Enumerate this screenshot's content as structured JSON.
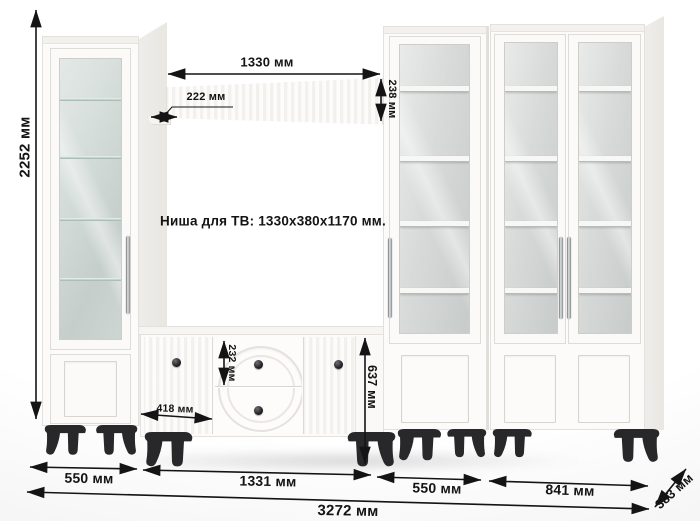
{
  "note": {
    "tv_niche": "Ниша для ТВ: 1330x380x1170 мм."
  },
  "dimensions": {
    "total_height": "2252 мм",
    "shelf_length": "1330 мм",
    "shelf_depth": "222 мм",
    "shelf_height": "238 мм",
    "drawer_height": "232 мм",
    "stand_door_width": "418 мм",
    "tv_stand_height": "637 мм",
    "left_cabinet_width": "550 мм",
    "tv_stand_width": "1331 мм",
    "right_cabinet_width": "550 мм",
    "double_cabinet_width": "841 мм",
    "total_width": "3272 мм",
    "unit_depth": "383 мм"
  },
  "colors": {
    "dimension_ink": "#141414",
    "furniture_white": "#fcfbfa",
    "glass_green": "#cdd6d2",
    "glass_gray": "#d3d7d6",
    "legs_black": "#28282b"
  }
}
